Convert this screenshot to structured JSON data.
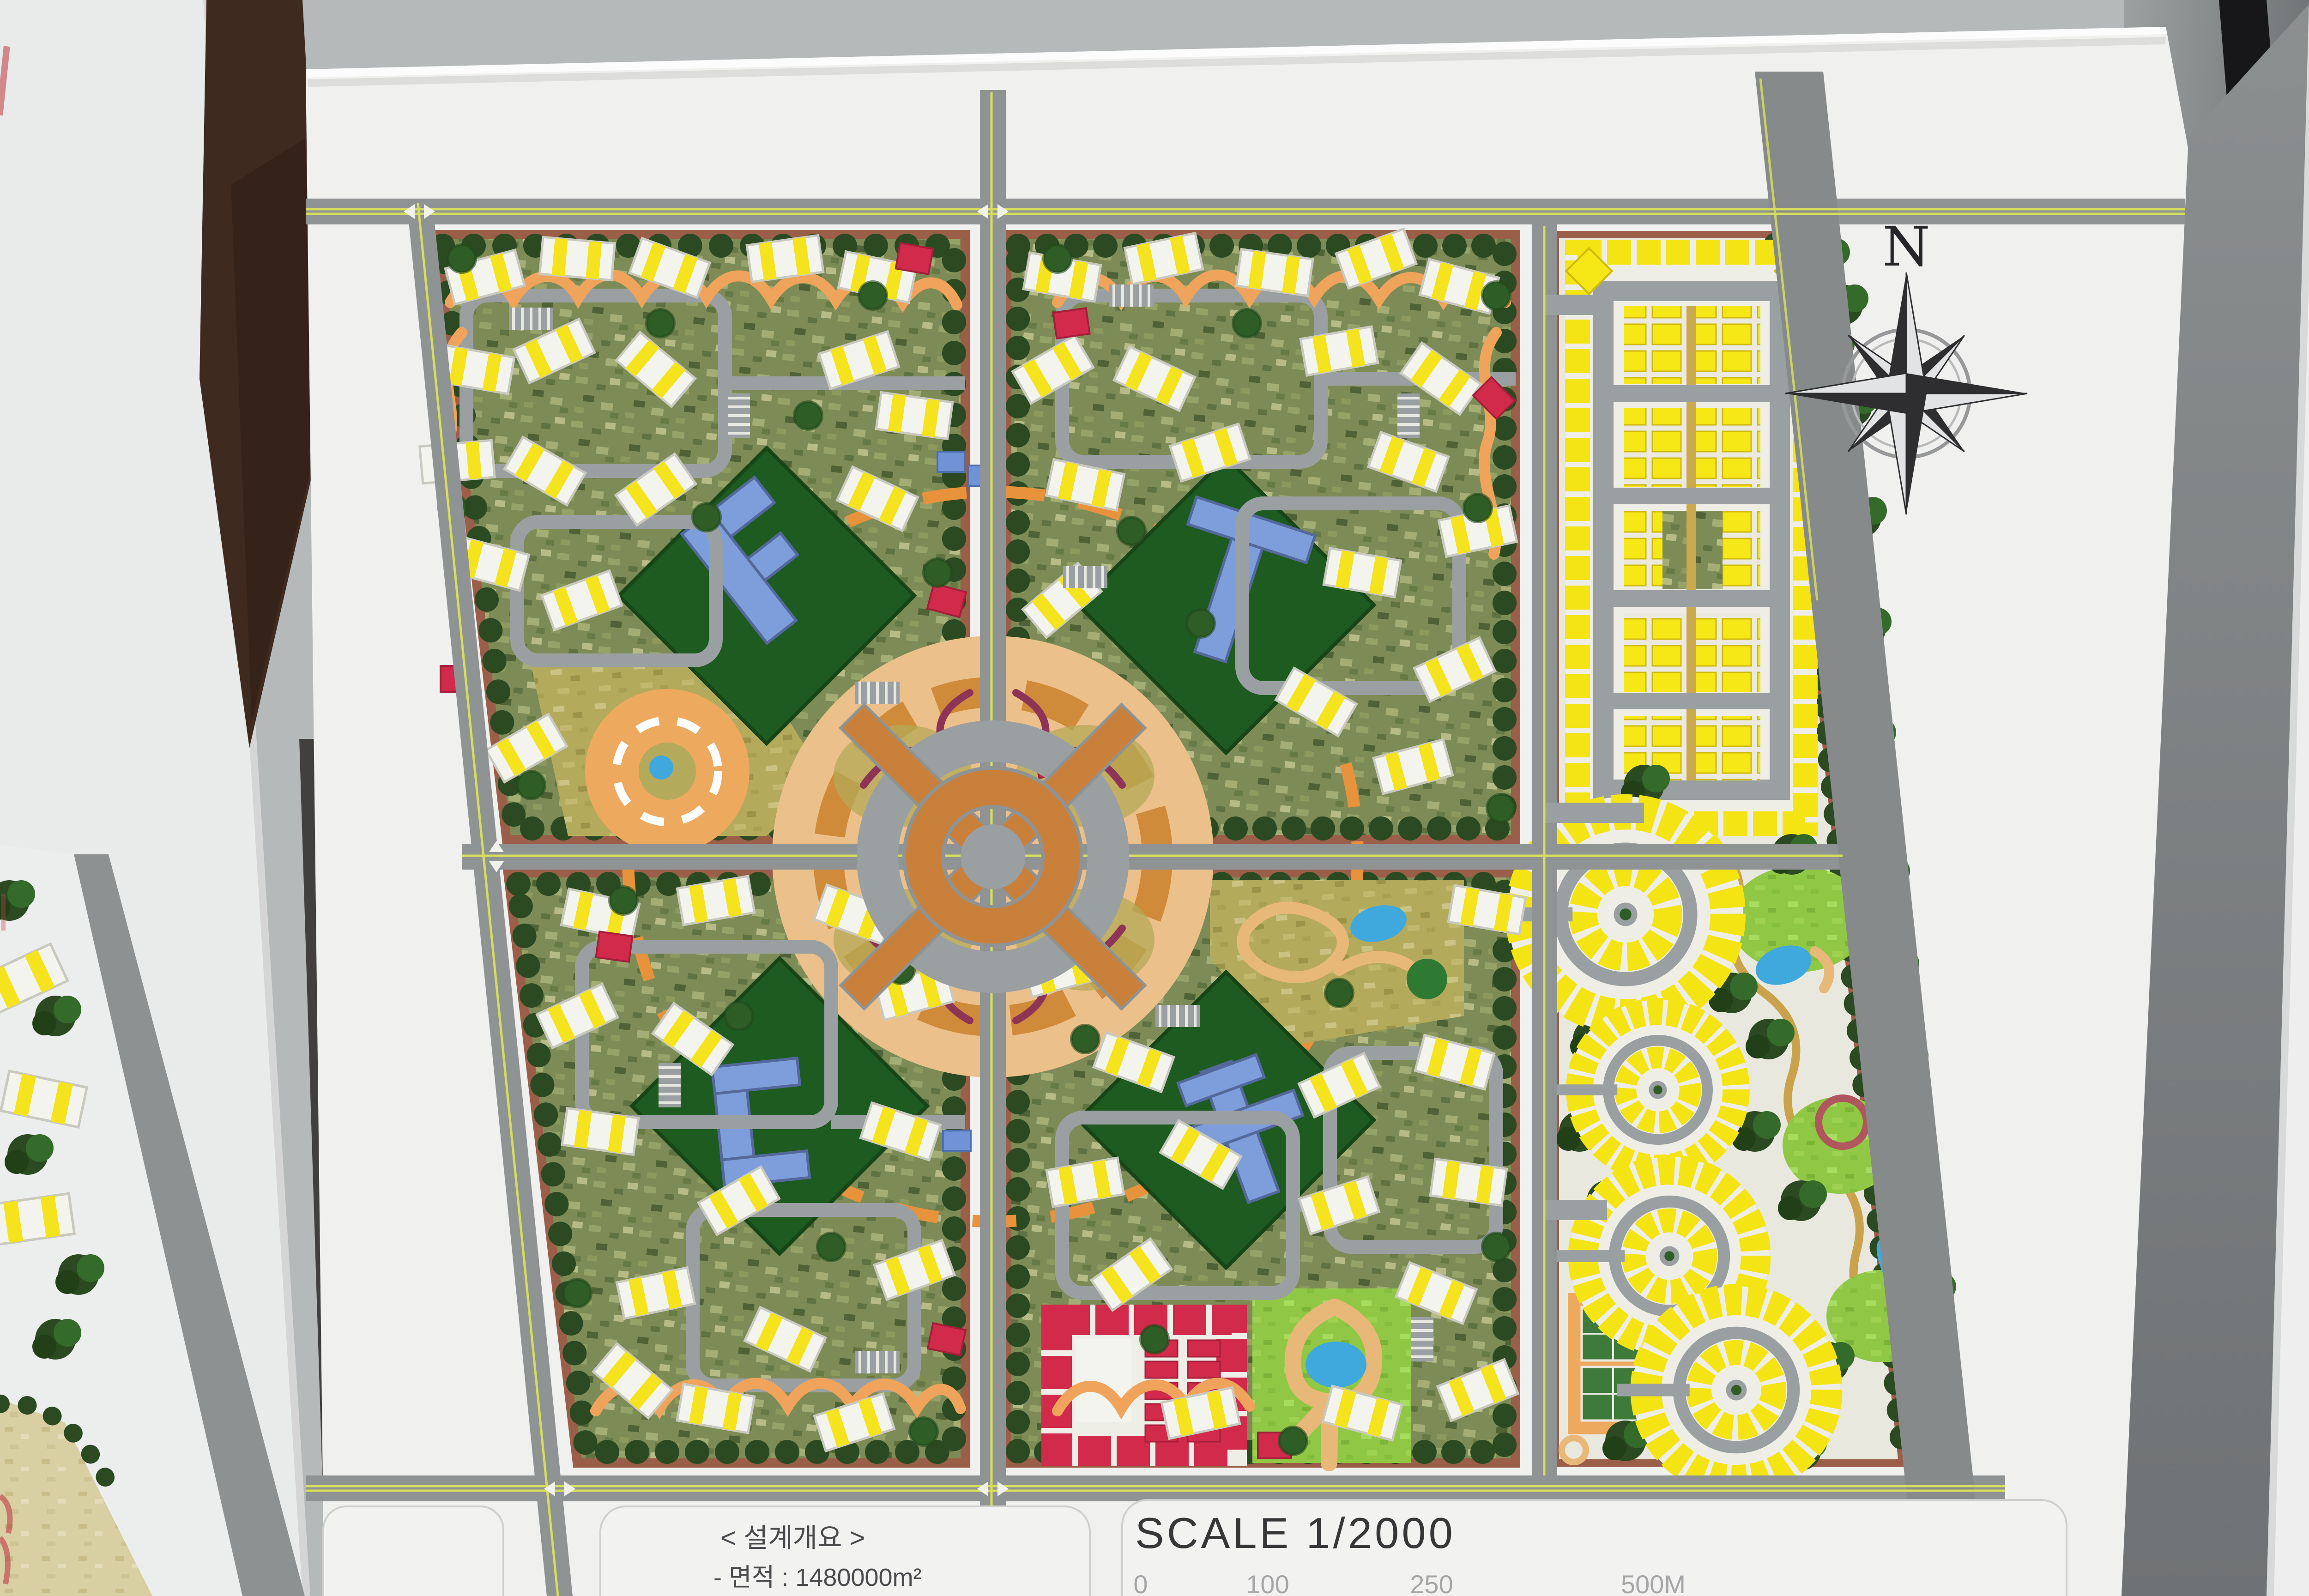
{
  "compass": {
    "north": "N"
  },
  "legend": {
    "scale_title": "SCALE  1/2000",
    "ticks": [
      "0",
      "100",
      "250",
      "500M"
    ]
  },
  "design_overview": {
    "title": "< 설계개요 >",
    "area": "- 면적 : 1480000m²",
    "population": "- 총 인구 : 17,571 명"
  },
  "handwriting": {
    "ratio": "1:2000",
    "scale_word": "SCALE",
    "code_line1": "208991447",
    "code_line2": "20899261K"
  },
  "colors": {
    "wall_gray": "#b6b9ba",
    "board_white": "#f0f0ee",
    "road_gray": "#8f9394",
    "road_centerline": "#d6de5c",
    "block_green": "#7d8c57",
    "hedge_green": "#2b4a22",
    "park_green": "#1e5b21",
    "lawn_green": "#8cc63e",
    "building_white": "#f4f4ef",
    "accent_yellow": "#f5e31d",
    "civic_blue": "#7d9edb",
    "housing_red": "#d12a4b",
    "plaza_tan": "#ecc08a",
    "path_orange": "#f0a45b",
    "pond_blue": "#3fa8dd",
    "sidewalk_brown": "#9b5e49"
  }
}
